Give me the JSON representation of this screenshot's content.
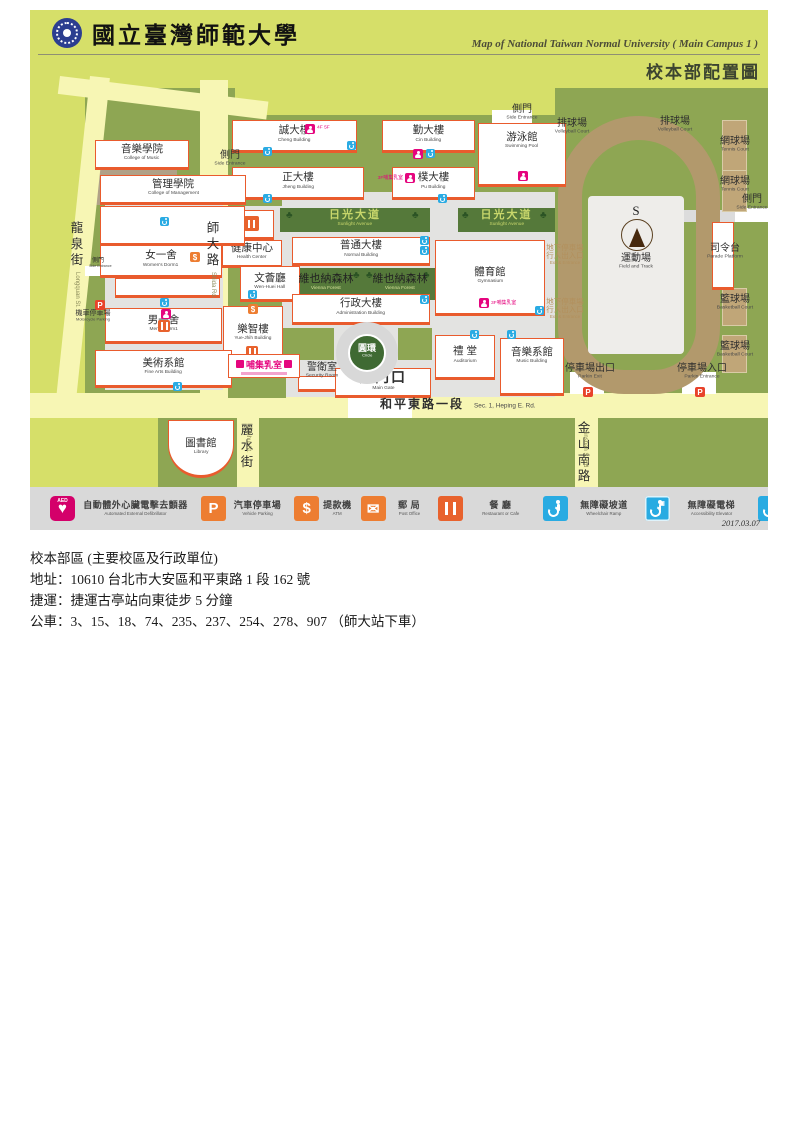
{
  "header": {
    "university_zh": "國立臺灣師範大學",
    "map_title_en": "Map of National Taiwan Normal University ( Main Campus 1 )",
    "map_title_zh": "校本部配置圖"
  },
  "legend": {
    "date": "2017.03.07",
    "items": [
      {
        "icon": "aed",
        "zh": "自動體外心臟電擊去顫器",
        "en": "Automated External Defibrillator"
      },
      {
        "icon": "park",
        "zh": "汽車停車場",
        "en": "Vehicle Parking"
      },
      {
        "icon": "atm",
        "zh": "提款機",
        "en": "ATM"
      },
      {
        "icon": "post",
        "zh": "郵 局",
        "en": "Post Office"
      },
      {
        "icon": "food",
        "zh": "餐 廳",
        "en": "Restaurant or Cafe"
      },
      {
        "icon": "wc-ramp",
        "zh": "無障礙坡道",
        "en": "Wheelchair Ramp"
      },
      {
        "icon": "wc-elev",
        "zh": "無障礙電梯",
        "en": "Accessibility Elevator"
      },
      {
        "icon": "wc-rest",
        "zh": "無障礙廁所",
        "en": "Restroom for the Disabled"
      },
      {
        "icon": "wc-park",
        "zh": "無障礙車位",
        "en": "Disabled Parking Only"
      }
    ]
  },
  "info": {
    "line1": "校本部區 (主要校區及行政單位)",
    "line2": "地址：10610 台北市大安區和平東路 1 段 162 號",
    "line3": "捷運：捷運古亭站向東徒步 5 分鐘",
    "line4": "公車：3、15、18、74、235、237、254、278、907 （師大站下車）"
  },
  "map": {
    "colors": {
      "bg": "#d6df69",
      "olive": "#8ea653",
      "road": "#f7f6b4",
      "path": "#e3e3e1",
      "track": "#b2996c",
      "infield": "#eeedea",
      "forest": "#55793a",
      "court": "#c0a678",
      "tan_block": "#b0a187"
    },
    "blocks": [
      {
        "id": "left-block",
        "x": 55,
        "y": 78,
        "w": 150,
        "h": 308
      },
      {
        "id": "central-block",
        "x": 198,
        "y": 105,
        "w": 327,
        "h": 285
      },
      {
        "id": "right-block",
        "x": 525,
        "y": 78,
        "w": 213,
        "h": 312
      },
      {
        "id": "library-block",
        "x": 128,
        "y": 408,
        "w": 79,
        "h": 69
      },
      {
        "id": "south-block-1",
        "x": 229,
        "y": 408,
        "w": 316,
        "h": 69
      },
      {
        "id": "south-block-2",
        "x": 568,
        "y": 408,
        "w": 170,
        "h": 69
      },
      {
        "id": "music-college-ground",
        "x": 55,
        "y": 140,
        "w": 92,
        "h": 55,
        "f": "#b0a187"
      }
    ],
    "roads": [
      {
        "id": "shida-rd",
        "x": 170,
        "y": 70,
        "w": 28,
        "h": 315
      },
      {
        "id": "longquan-st",
        "x": 60,
        "y": 66,
        "w": 20,
        "h": 330,
        "rot": 6
      },
      {
        "id": "north-lane",
        "x": 30,
        "y": 66,
        "w": 210,
        "h": 18,
        "rot": 7
      },
      {
        "id": "heping-e-rd",
        "x": 0,
        "y": 383,
        "w": 738,
        "h": 25
      },
      {
        "id": "lishui-st",
        "x": 207,
        "y": 408,
        "w": 22,
        "h": 69
      },
      {
        "id": "jinshan-s-rd",
        "x": 545,
        "y": 408,
        "w": 23,
        "h": 69
      }
    ],
    "paths": [
      {
        "x": 252,
        "y": 182,
        "w": 273,
        "h": 205
      },
      {
        "x": 198,
        "y": 196,
        "w": 58,
        "h": 44
      },
      {
        "x": 75,
        "y": 188,
        "w": 118,
        "h": 192
      }
    ],
    "patches": [
      {
        "x": 252,
        "y": 318,
        "w": 52,
        "h": 32
      },
      {
        "x": 368,
        "y": 318,
        "w": 34,
        "h": 32
      },
      {
        "x": 198,
        "y": 338,
        "w": 58,
        "h": 50
      }
    ],
    "stubs": [
      {
        "x": 462,
        "y": 100,
        "w": 40,
        "h": 13,
        "f": "#ffffff"
      },
      {
        "x": 645,
        "y": 200,
        "w": 60,
        "h": 12,
        "f": "#dcdcdc"
      },
      {
        "x": 705,
        "y": 198,
        "w": 33,
        "h": 14,
        "f": "#ffffff"
      },
      {
        "x": 540,
        "y": 362,
        "w": 34,
        "h": 22,
        "f": "#ffffff"
      },
      {
        "x": 652,
        "y": 362,
        "w": 34,
        "h": 22,
        "f": "#ffffff"
      },
      {
        "x": 318,
        "y": 384,
        "w": 64,
        "h": 24,
        "f": "#ffffff"
      },
      {
        "x": 55,
        "y": 256,
        "w": 20,
        "h": 10,
        "f": "#ffffff"
      }
    ],
    "track": {
      "x": 528,
      "y": 106,
      "w": 162,
      "h": 278,
      "b": 24,
      "r": "81px 81px 66px 66px"
    },
    "infield": {
      "x": 558,
      "y": 186,
      "w": 96,
      "h": 158
    },
    "courts": [
      {
        "x": 692,
        "y": 110,
        "w": 25,
        "h": 57
      },
      {
        "x": 692,
        "y": 160,
        "w": 25,
        "h": 42
      },
      {
        "x": 692,
        "y": 278,
        "w": 25,
        "h": 38
      },
      {
        "x": 692,
        "y": 325,
        "w": 25,
        "h": 38
      }
    ],
    "greens": [
      {
        "id": "sunlight-avenue-1",
        "cls": "ave",
        "zh": "日光大道",
        "en": "Sunlight Avenue",
        "x": 250,
        "y": 198,
        "w": 150,
        "h": 24,
        "trees": [
          6,
          132
        ]
      },
      {
        "id": "sunlight-avenue-2",
        "cls": "ave",
        "zh": "日光大道",
        "en": "Sunlight Avenue",
        "x": 428,
        "y": 198,
        "w": 97,
        "h": 24,
        "trees": [
          4,
          82
        ]
      },
      {
        "id": "vienna-forest-1",
        "cls": "forest",
        "zh": "維也納森林",
        "en": "Vienna Forest",
        "x": 255,
        "y": 258,
        "w": 82,
        "h": 32,
        "trees": [
          3,
          68
        ]
      },
      {
        "id": "vienna-forest-2",
        "cls": "forest",
        "zh": "維也納森林",
        "en": "Vienna Forest",
        "x": 333,
        "y": 258,
        "w": 74,
        "h": 32,
        "trees": [
          3,
          60
        ]
      }
    ],
    "buildings": [
      {
        "id": "cheng",
        "zh": "誠大樓",
        "en": "Cheng Building",
        "x": 202,
        "y": 110,
        "w": 125,
        "h": 33
      },
      {
        "id": "cin",
        "zh": "勤大樓",
        "en": "Cin Building",
        "x": 352,
        "y": 110,
        "w": 93,
        "h": 33
      },
      {
        "id": "jheng",
        "zh": "正大樓",
        "en": "Jheng Building",
        "x": 202,
        "y": 157,
        "w": 132,
        "h": 33
      },
      {
        "id": "pu",
        "zh": "樸大樓",
        "en": "Pu Building",
        "x": 362,
        "y": 157,
        "w": 83,
        "h": 33
      },
      {
        "id": "swimming-pool",
        "zh": "游泳館",
        "en": "Swimming Pool",
        "x": 448,
        "y": 113,
        "w": 88,
        "h": 64,
        "up": true
      },
      {
        "id": "restaurant-hut",
        "zh": "",
        "en": "",
        "x": 202,
        "y": 200,
        "w": 42,
        "h": 30
      },
      {
        "id": "health-center",
        "zh": "健康中心",
        "en": "Health Center",
        "x": 192,
        "y": 230,
        "w": 60,
        "h": 28
      },
      {
        "id": "normal-building",
        "zh": "普通大樓",
        "en": "Normal Building",
        "x": 262,
        "y": 227,
        "w": 138,
        "h": 29
      },
      {
        "id": "wen-huei-hall",
        "zh": "文薈廳",
        "en": "Wen-Huei Hall",
        "x": 210,
        "y": 256,
        "w": 60,
        "h": 36
      },
      {
        "id": "administration",
        "zh": "行政大樓",
        "en": "Administration Building",
        "x": 262,
        "y": 284,
        "w": 138,
        "h": 31
      },
      {
        "id": "gymnasium",
        "zh": "體育館",
        "en": "Gymnasium",
        "x": 405,
        "y": 230,
        "w": 110,
        "h": 76
      },
      {
        "id": "yue-jhih",
        "zh": "樂智樓",
        "en": "Yue-Jhih Building",
        "x": 193,
        "y": 296,
        "w": 60,
        "h": 58
      },
      {
        "id": "main-gate",
        "zh": "大門口",
        "en": "Main Gate",
        "x": 305,
        "y": 358,
        "w": 96,
        "h": 30,
        "big": true
      },
      {
        "id": "auditorium",
        "zh": "禮 堂",
        "en": "Auditorium",
        "x": 405,
        "y": 325,
        "w": 60,
        "h": 45
      },
      {
        "id": "music-building",
        "zh": "音樂系館",
        "en": "Music Building",
        "x": 470,
        "y": 328,
        "w": 64,
        "h": 58,
        "up": true
      },
      {
        "id": "library",
        "zh": "圖書館",
        "en": "Library",
        "x": 138,
        "y": 410,
        "w": 66,
        "h": 58,
        "round": true
      },
      {
        "id": "college-of-music",
        "zh": "音樂學院",
        "en": "College of Music",
        "x": 65,
        "y": 130,
        "w": 94,
        "h": 30
      },
      {
        "id": "college-of-management",
        "zh": "管理學院",
        "en": "College of Management",
        "x": 70,
        "y": 165,
        "w": 146,
        "h": 30
      },
      {
        "id": "annex-a",
        "zh": "",
        "en": "",
        "x": 70,
        "y": 196,
        "w": 145,
        "h": 40
      },
      {
        "id": "womens-dorm1",
        "zh": "女一舍",
        "en": "Women's Dorm1",
        "x": 70,
        "y": 235,
        "w": 122,
        "h": 33
      },
      {
        "id": "annex-b",
        "zh": "",
        "en": "",
        "x": 85,
        "y": 268,
        "w": 105,
        "h": 20
      },
      {
        "id": "mens-dorm1",
        "zh": "男一舍",
        "en": "Men's Dorm1",
        "x": 75,
        "y": 298,
        "w": 117,
        "h": 36
      },
      {
        "id": "fine-arts",
        "zh": "美術系館",
        "en": "Fine Arts Building",
        "x": 65,
        "y": 340,
        "w": 137,
        "h": 38
      },
      {
        "id": "parade-platform",
        "zh": "",
        "en": "",
        "x": 682,
        "y": 212,
        "w": 22,
        "h": 68
      },
      {
        "id": "security-hut",
        "zh": "",
        "en": "",
        "x": 268,
        "y": 366,
        "w": 38,
        "h": 16
      }
    ],
    "circle": {
      "zh": "圓環",
      "en": "Circle",
      "ox": 306,
      "oy": 312,
      "od": 62,
      "ix": 318,
      "iy": 324,
      "idm": 38,
      "fill": "#3f6a33"
    },
    "labels": [
      {
        "id": "side-entrance-top",
        "zh": "側門",
        "en": "Side Entrance",
        "x": 462,
        "y": 94,
        "w": 60
      },
      {
        "id": "side-entrance-left",
        "zh": "側門",
        "en": "Side Entrance",
        "x": 172,
        "y": 140,
        "w": 56
      },
      {
        "id": "side-entrance-right",
        "zh": "側門",
        "en": "Side Entrance",
        "x": 692,
        "y": 184,
        "w": 60
      },
      {
        "id": "side-entrance-dorm",
        "zh": "側門",
        "en": "Side Entrance",
        "x": 48,
        "y": 248,
        "w": 40,
        "cls": "tiny"
      },
      {
        "id": "volleyball-court-1",
        "zh": "排球場",
        "en": "Volleyball Court",
        "x": 512,
        "y": 108,
        "w": 60
      },
      {
        "id": "volleyball-court-2",
        "zh": "排球場",
        "en": "Volleyball Court",
        "x": 615,
        "y": 106,
        "w": 60
      },
      {
        "id": "tennis-court-1",
        "zh": "網球場",
        "en": "Tennis Court",
        "x": 675,
        "y": 126,
        "w": 60
      },
      {
        "id": "tennis-court-2",
        "zh": "網球場",
        "en": "Tennis Court",
        "x": 675,
        "y": 166,
        "w": 60
      },
      {
        "id": "basketball-court-1",
        "zh": "籃球場",
        "en": "Basketball Court",
        "x": 675,
        "y": 284,
        "w": 60
      },
      {
        "id": "basketball-court-2",
        "zh": "籃球場",
        "en": "Basketball Court",
        "x": 675,
        "y": 331,
        "w": 60
      },
      {
        "id": "parade-platform-label",
        "zh": "司令台",
        "en": "Parade Platform",
        "x": 660,
        "y": 233,
        "w": 70
      },
      {
        "id": "parking-exit",
        "zh": "停車場出口",
        "en": "Parkin Exit",
        "x": 520,
        "y": 353,
        "w": 80
      },
      {
        "id": "parking-entrance",
        "zh": "停車場入口",
        "en": "Parkin Entrance",
        "x": 632,
        "y": 353,
        "w": 80
      },
      {
        "id": "motorcycle-parking",
        "zh": "機車停車場",
        "en": "Motorcycle Parking",
        "x": 28,
        "y": 300,
        "w": 70,
        "cls": "small"
      },
      {
        "id": "underground-exit-1",
        "zh": "地下停車場",
        "zh2": "行人出入口",
        "en": "Exit & Entrance",
        "x": 500,
        "y": 234,
        "w": 70,
        "cls": "tan"
      },
      {
        "id": "underground-exit-2",
        "zh": "地下停車場",
        "zh2": "行人出入口",
        "en": "Exit & Entrance",
        "x": 500,
        "y": 288,
        "w": 70,
        "cls": "tan"
      },
      {
        "id": "field-and-track",
        "zh": "運動場",
        "en": "Field and Track",
        "x": 570,
        "y": 243,
        "w": 72
      },
      {
        "id": "security-room",
        "zh": "警衛室",
        "en": "Security Room",
        "x": 262,
        "y": 352,
        "w": 60
      },
      {
        "id": "heping-e-rd-label",
        "zh": "和平東路一段",
        "en": "Sec. 1, Heping E. Rd.",
        "x": 350,
        "y": 388,
        "cls": "row"
      }
    ],
    "vroads": [
      {
        "id": "longquan",
        "zh": "龍泉街",
        "en": "Longquan St.",
        "x": 40,
        "y": 210,
        "enx": 50,
        "eny": 262
      },
      {
        "id": "shida",
        "zh": "師大路",
        "en": "Shida Rd.",
        "x": 176,
        "y": 210,
        "enx": 186,
        "eny": 262
      },
      {
        "id": "lishui",
        "zh": "麗水街",
        "en": "Lishui St.",
        "x": 210,
        "y": 412,
        "enx": 221,
        "eny": 418
      },
      {
        "id": "jinshan",
        "zh": "金山南路",
        "en": "Jinshan S. Rd",
        "x": 547,
        "y": 410,
        "enx": 558,
        "eny": 420
      }
    ],
    "icons": [
      {
        "t": "blue",
        "x": 233,
        "y": 137
      },
      {
        "t": "blue",
        "x": 317,
        "y": 131
      },
      {
        "t": "pink",
        "x": 383,
        "y": 139
      },
      {
        "t": "blue",
        "x": 396,
        "y": 139
      },
      {
        "t": "blue",
        "x": 233,
        "y": 184
      },
      {
        "t": "blue",
        "x": 408,
        "y": 184
      },
      {
        "t": "blue",
        "x": 390,
        "y": 226
      },
      {
        "t": "blue",
        "x": 390,
        "y": 236
      },
      {
        "t": "blue",
        "x": 390,
        "y": 285
      },
      {
        "t": "blue",
        "x": 505,
        "y": 296
      },
      {
        "t": "blue",
        "x": 440,
        "y": 320
      },
      {
        "t": "blue",
        "x": 477,
        "y": 320
      },
      {
        "t": "blue",
        "x": 130,
        "y": 207
      },
      {
        "t": "blue",
        "x": 130,
        "y": 288
      },
      {
        "t": "pink",
        "x": 131,
        "y": 299
      },
      {
        "t": "food",
        "x": 128,
        "y": 310
      },
      {
        "t": "blue",
        "x": 143,
        "y": 372
      },
      {
        "t": "blue",
        "x": 218,
        "y": 280
      },
      {
        "t": "atm",
        "x": 218,
        "y": 294,
        "g": "$"
      },
      {
        "t": "atm",
        "x": 160,
        "y": 242,
        "g": "$"
      },
      {
        "t": "food",
        "x": 216,
        "y": 336
      },
      {
        "t": "blue",
        "x": 253,
        "y": 355
      },
      {
        "t": "redp",
        "x": 65,
        "y": 290,
        "g": "P"
      },
      {
        "t": "redp",
        "x": 553,
        "y": 377,
        "g": "P"
      },
      {
        "t": "redp",
        "x": 665,
        "y": 377,
        "g": "P"
      },
      {
        "t": "pink",
        "x": 275,
        "y": 114,
        "txt": "4F 5F"
      },
      {
        "t": "pink",
        "x": 375,
        "y": 163,
        "txtl": "3F哺集乳室"
      },
      {
        "t": "pink",
        "x": 449,
        "y": 288,
        "txt": "3F哺集乳室"
      },
      {
        "t": "pink",
        "x": 488,
        "y": 161
      },
      {
        "t": "food",
        "x": 214,
        "y": 206,
        "big": true
      }
    ],
    "badge": {
      "zh": "哺集乳室",
      "x": 198,
      "y": 344,
      "w": 70,
      "h": 22
    },
    "compass": {
      "s": "S",
      "sx": 591,
      "sy": 193,
      "cx": 591,
      "cy": 209,
      "d": 30
    }
  }
}
